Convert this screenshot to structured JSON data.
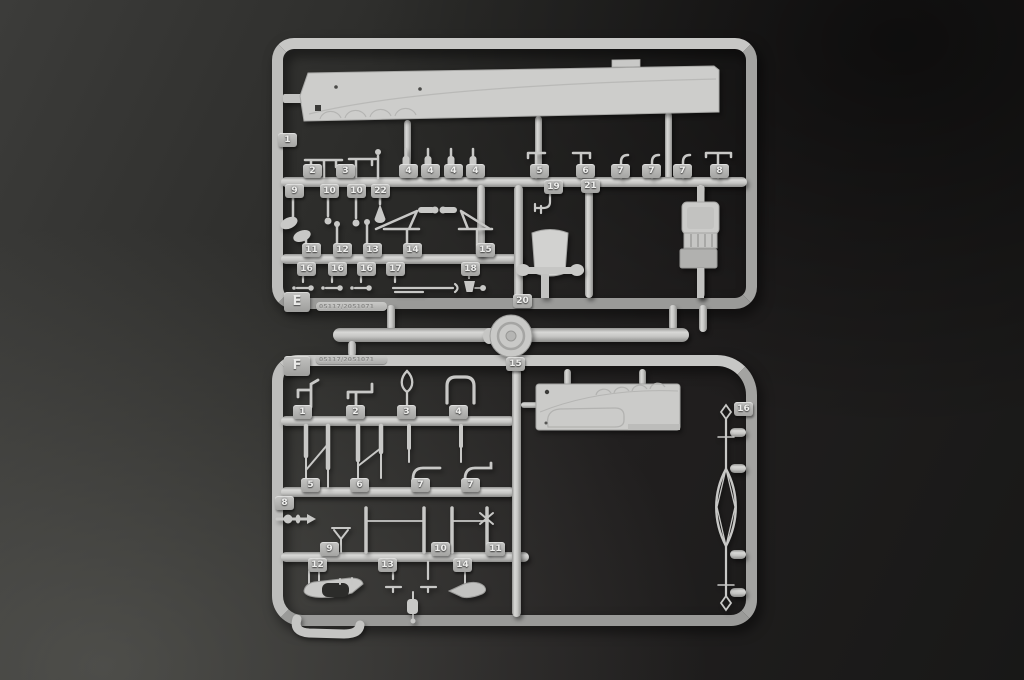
{
  "colors": {
    "background_dark": "#181817",
    "background_light": "#4a4a47",
    "plastic": "#c2c2c0",
    "plastic_highlight": "#d8d8d6",
    "plastic_shadow": "#8d8d8b"
  },
  "sprue_e": {
    "label": "E",
    "mold_code": "05117/2051071",
    "part_tabs": [
      "1",
      "2",
      "3",
      "4",
      "4",
      "4",
      "4",
      "5",
      "6",
      "7",
      "7",
      "7",
      "8",
      "9",
      "10",
      "10",
      "22",
      "19",
      "21",
      "11",
      "12",
      "13",
      "14",
      "15",
      "16",
      "16",
      "16",
      "17",
      "18",
      "20"
    ]
  },
  "sprue_f": {
    "label": "F",
    "mold_code": "05117/2051071",
    "part_tabs": [
      "15",
      "1",
      "2",
      "3",
      "4",
      "5",
      "6",
      "7",
      "7",
      "8",
      "9",
      "10",
      "11",
      "12",
      "13",
      "14",
      "16"
    ]
  }
}
